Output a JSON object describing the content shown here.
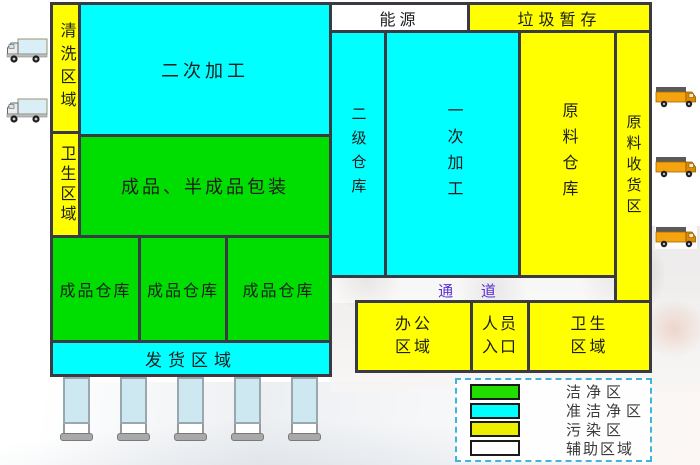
{
  "diagram": {
    "regions": {
      "qingxi": {
        "label": "清洗区域",
        "zone": "污染区"
      },
      "erci_jiagong": {
        "label": "二次加工",
        "zone": "准洁净区"
      },
      "weisheng_left": {
        "label": "卫生区域",
        "zone": "污染区"
      },
      "chengpin_baozhuang": {
        "label": "成品、半成品包装",
        "zone": "洁净区"
      },
      "chengpin_cangku_1": {
        "label": "成品仓库",
        "zone": "洁净区"
      },
      "chengpin_cangku_2": {
        "label": "成品仓库",
        "zone": "洁净区"
      },
      "chengpin_cangku_3": {
        "label": "成品仓库",
        "zone": "洁净区"
      },
      "fahuo": {
        "label": "发货区域",
        "zone": "准洁净区"
      },
      "nengyuan": {
        "label": "能源",
        "zone": "辅助区域"
      },
      "laji_zancun": {
        "label": "垃圾暂存",
        "zone": "污染区"
      },
      "erji_cangku": {
        "label": "二级仓库",
        "zone": "准洁净区"
      },
      "yici_jiagong": {
        "label": "一次加工",
        "zone": "准洁净区"
      },
      "yuanliao_cangku": {
        "label": "原料仓库",
        "zone": "污染区"
      },
      "yuanliao_shouhuo": {
        "label": "原料收货区",
        "zone": "污染区"
      },
      "tongdao": {
        "label": "通  道"
      },
      "bangong": {
        "line1": "办公",
        "line2": "区域",
        "zone": "污染区"
      },
      "renyuan_rukou": {
        "line1": "人员",
        "line2": "入口",
        "zone": "污染区"
      },
      "weisheng_right": {
        "line1": "卫生",
        "line2": "区域",
        "zone": "污染区"
      }
    },
    "legend": {
      "items": [
        {
          "label": "洁净区",
          "color": "#22dd00"
        },
        {
          "label": "准洁净区",
          "color": "#00ffff"
        },
        {
          "label": "污染区",
          "color": "#eeee00"
        },
        {
          "label": "辅助区域",
          "color": "#ffffff"
        }
      ]
    },
    "colors": {
      "clean_zone": "#00dd00",
      "semi_clean_zone": "#00ffff",
      "polluted_zone": "#ffff00",
      "auxiliary_zone": "#ffffff",
      "wall_border": "#3a3a42",
      "tongdao_text": "#5b2fd0",
      "left_truck_cargo": "#d9eef6",
      "right_truck_body": "#f5a30f",
      "dock_door": "#cde8f0"
    },
    "decorations": {
      "left_trucks": 2,
      "right_trucks": 3,
      "loading_docks": 5
    }
  }
}
